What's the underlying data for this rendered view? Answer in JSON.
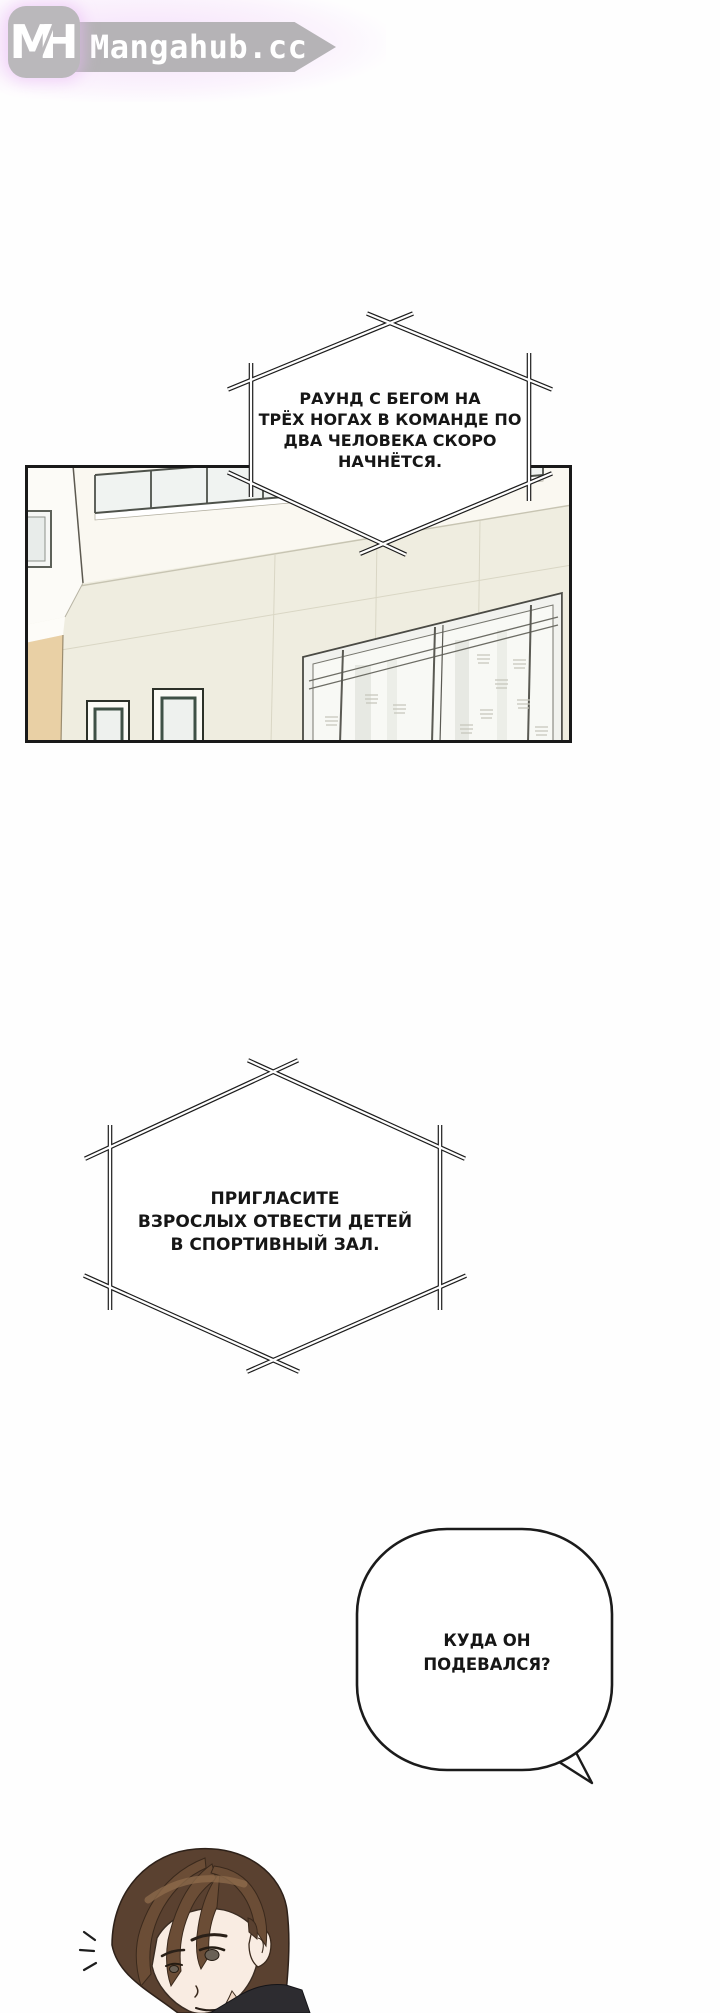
{
  "site": {
    "logo_initial_m": "M",
    "logo_initial_h": "H",
    "logo_text": "Mangahub.cc"
  },
  "bubbles": [
    {
      "shape": "hexagon-announcement",
      "lines": [
        "РАУНД С БЕГОМ НА",
        "ТРЁХ НОГАХ В КОМАНДЕ ПО",
        "ДВА ЧЕЛОВЕКА СКОРО",
        "НАЧНЁТСЯ."
      ]
    },
    {
      "shape": "hexagon-announcement",
      "lines": [
        "ПРИГЛАСИТЕ",
        "ВЗРОСЛЫХ ОТВЕСТИ ДЕТЕЙ",
        "В СПОРТИВНЫЙ ЗАЛ."
      ]
    },
    {
      "shape": "rounded-speech",
      "lines": [
        "КУДА ОН",
        "ПОДЕВАЛСЯ?"
      ]
    }
  ],
  "scene": {
    "panel_subject": "school-building-exterior",
    "character": "young-man-brown-hair"
  },
  "colors": {
    "logo_gray": "#b5b3b6",
    "logo_text": "#ffffff",
    "glow_pink": "#eec6f8",
    "ink": "#1b1b1b",
    "wall_cream": "#efede0",
    "wall_tan": "#e9d0a5",
    "window_green": "#3f5146",
    "hair_brown": "#5a4130"
  }
}
